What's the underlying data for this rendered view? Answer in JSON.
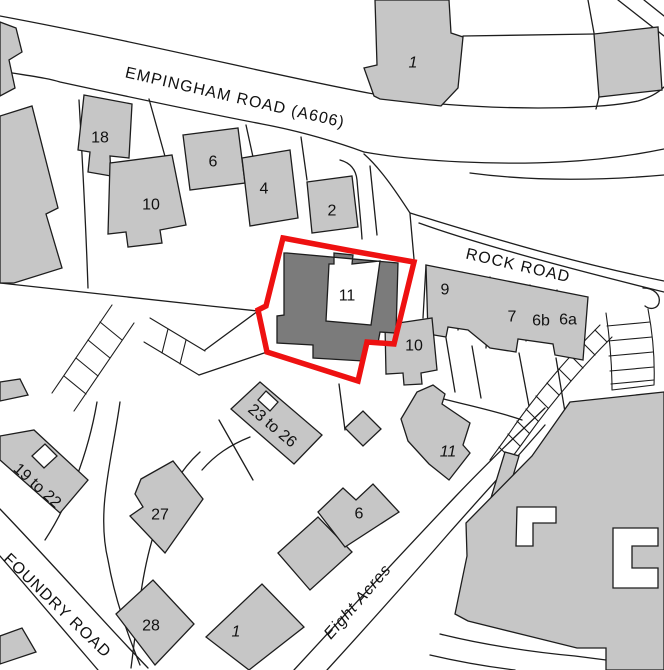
{
  "page": {
    "title": "Site location plan"
  },
  "colors": {
    "line_color": "#1d1d1d",
    "building_fill": "#c6c6c6",
    "subject_fill": "#7b7b7b",
    "boundary_color": "#ee1111",
    "background": "#ffffff",
    "label_color": "#111111"
  },
  "labels": {
    "roads": {
      "empingham": "EMPINGHAM ROAD (A606)",
      "rock": "ROCK ROAD",
      "foundry": "FOUNDRY ROAD",
      "eight_acres": "Eight Acres"
    },
    "buildings": {
      "b18": "18",
      "b6": "6",
      "b10": "10",
      "b4": "4",
      "b2": "2",
      "b1_top": "1",
      "b11_subject": "11",
      "b9": "9",
      "b10_rock": "10",
      "b7": "7",
      "b6b": "6b",
      "b6a": "6a",
      "b23_26": "23 to 26",
      "b19_22": "19 to 22",
      "b27": "27",
      "b11_south": "11",
      "b6_south": "6",
      "b28": "28",
      "b1_south": "1"
    }
  }
}
